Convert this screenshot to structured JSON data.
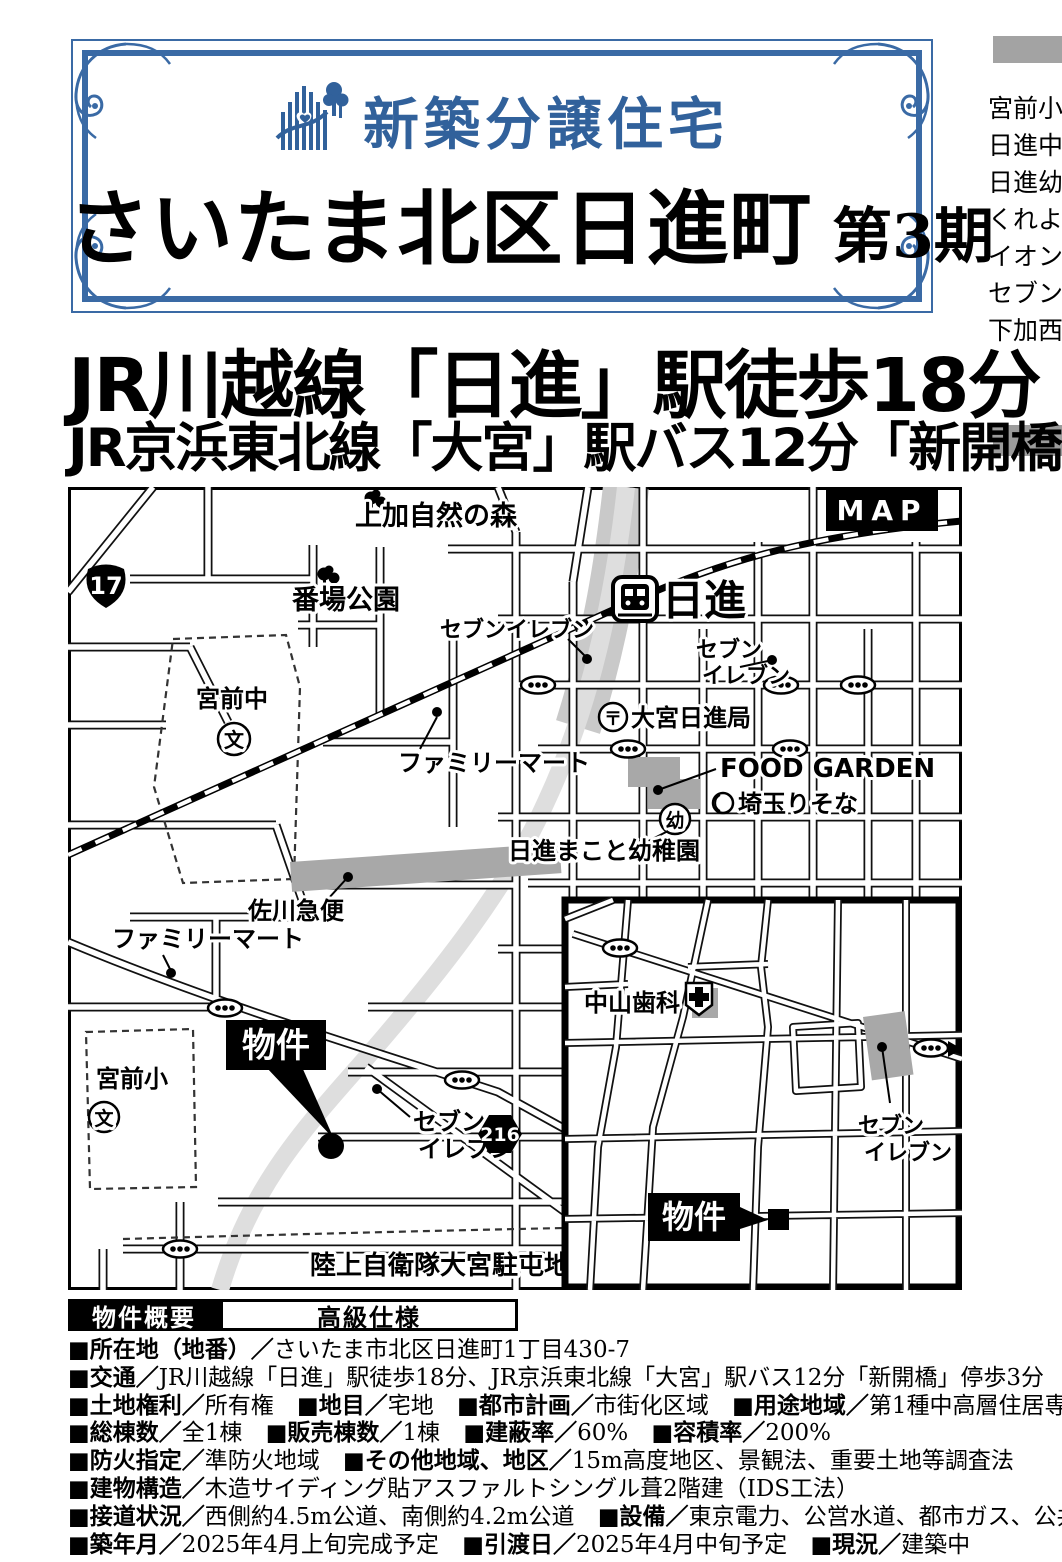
{
  "colors": {
    "accent_blue": "#31619b",
    "gray_bar": "#a3a3a3",
    "building_gray": "#a8a8a8"
  },
  "sidebar_right": {
    "items": [
      "宮前小",
      "日進中",
      "日進幼",
      "くれよん",
      "イオン",
      "セブン",
      "下加西"
    ]
  },
  "header": {
    "brand_label": "新築分譲住宅",
    "title": "さいたま北区日進町",
    "title_suffix": "第3期"
  },
  "headlines": {
    "line1": "JR川越線「日進」駅徒歩18分",
    "line2": "JR京浜東北線「大宮」駅バス12分「新開橋」停歩3分"
  },
  "map": {
    "banner": "MAP",
    "station_name": "日進",
    "route17": "17",
    "route216": "216",
    "marker_label": "物件",
    "labels": {
      "kamika_forest": "上加自然の森",
      "banba_park": "番場公園",
      "miyamae_jhs": "宮前中",
      "school_mark": "文",
      "seven_upper": "セブンイレブン",
      "seven_station_1": "セブン",
      "seven_station_2": "イレブン",
      "post_mark": "〒",
      "post_office": "大宮日進局",
      "food_garden": "FOOD GARDEN",
      "kinder_mark": "幼",
      "risona_bank": "埼玉りそな",
      "makoto_kinder": "日進まこと幼稚園",
      "familymart_upper": "ファミリーマート",
      "sagawa": "佐川急便",
      "familymart_lower": "ファミリーマート",
      "miyamae_es": "宮前小",
      "seven_lower_1": "セブン",
      "seven_lower_2": "イレブン",
      "jsdf_base": "陸上自衛隊大宮駐屯地"
    }
  },
  "inset": {
    "labels": {
      "nakayama_dental": "中山歯科",
      "seven_1": "セブン",
      "seven_2": "イレブン",
      "marker_label": "物件"
    }
  },
  "overview": {
    "tab1": "物件概要",
    "tab2": "高級仕様",
    "rows": [
      {
        "segments": [
          {
            "label": "■所在地（地番）／",
            "value": "さいたま市北区日進町1丁目430-7"
          }
        ]
      },
      {
        "segments": [
          {
            "label": "■交通／",
            "value": "JR川越線「日進」駅徒歩18分、JR京浜東北線「大宮」駅バス12分「新開橋」停歩3分"
          }
        ]
      },
      {
        "segments": [
          {
            "label": "■土地権利／",
            "value": "所有権"
          },
          {
            "label": "■地目／",
            "value": "宅地"
          },
          {
            "label": "■都市計画／",
            "value": "市街化区域"
          },
          {
            "label": "■用途地域／",
            "value": "第1種中高層住居専用地域"
          }
        ]
      },
      {
        "segments": [
          {
            "label": "■総棟数／",
            "value": "全1棟"
          },
          {
            "label": "■販売棟数／",
            "value": "1棟"
          },
          {
            "label": "■建蔽率／",
            "value": "60%"
          },
          {
            "label": "■容積率／",
            "value": "200%"
          }
        ]
      },
      {
        "segments": [
          {
            "label": "■防火指定／",
            "value": "準防火地域"
          },
          {
            "label": "■その他地域、地区／",
            "value": "15m高度地区、景観法、重要土地等調査法"
          }
        ]
      },
      {
        "segments": [
          {
            "label": "■建物構造／",
            "value": "木造サイディング貼アスファルトシングル葺2階建（IDS工法）"
          }
        ]
      },
      {
        "segments": [
          {
            "label": "■接道状況／",
            "value": "西側約4.5m公道、南側約4.2m公道"
          },
          {
            "label": "■設備／",
            "value": "東京電力、公営水道、都市ガス、公共下水"
          }
        ]
      },
      {
        "segments": [
          {
            "label": "■築年月／",
            "value": "2025年4月上旬完成予定"
          },
          {
            "label": "■引渡日／",
            "value": "2025年4月中旬予定"
          },
          {
            "label": "■現況／",
            "value": "建築中"
          }
        ]
      }
    ]
  }
}
